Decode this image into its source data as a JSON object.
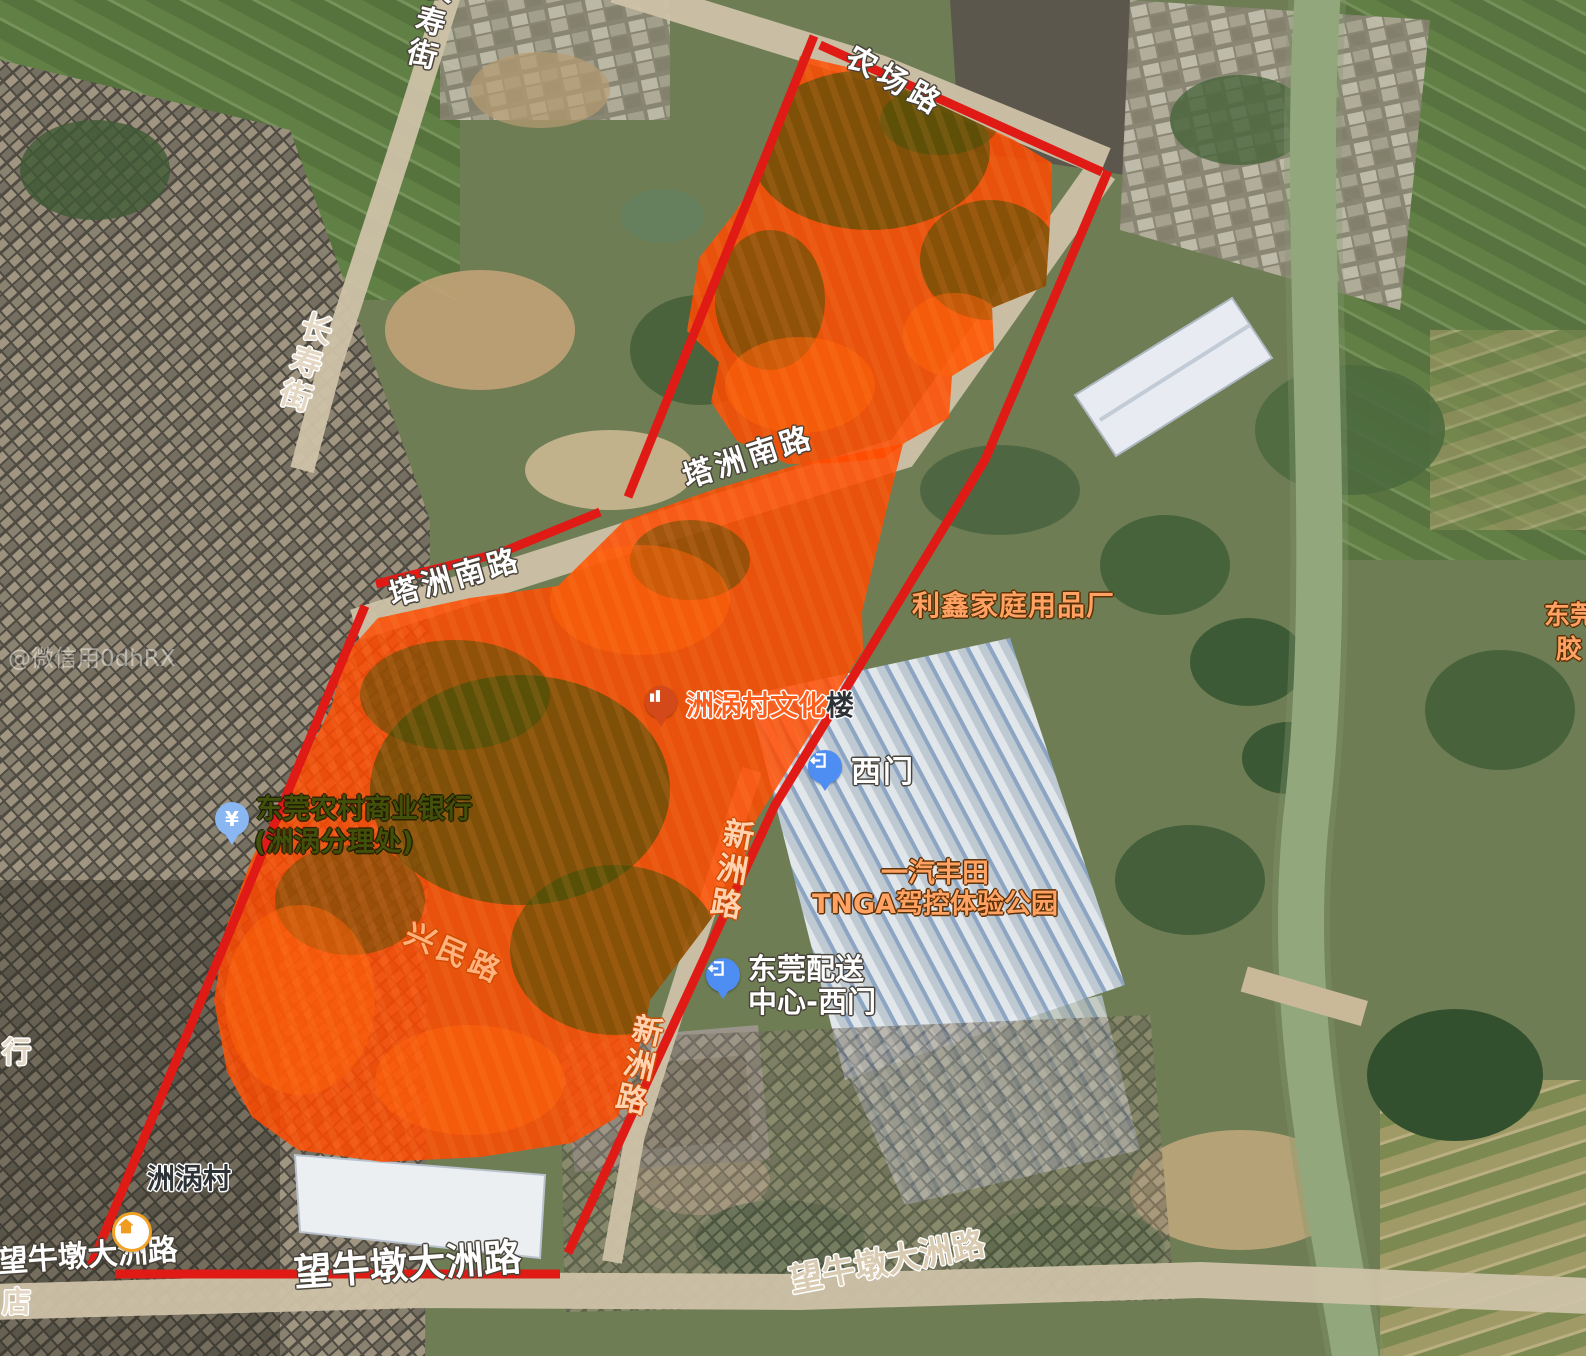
{
  "map": {
    "watermark": "@微信用0dhRX",
    "colors": {
      "boundary": "#e01b16",
      "highlight": "#ff4a00",
      "marker_blue": "#4e8df2",
      "marker_lightblue": "#8ab6f2",
      "marker_orange": "#d4491a",
      "home_orange": "#ef9c20"
    },
    "roads": {
      "changshou_top": "长寿街",
      "changshou_mid": "长寿街",
      "nongchang": "农场路",
      "tazhou_upper": "塔洲南路",
      "tazhou_lower": "塔洲南路",
      "xingmin": "兴民路",
      "xinzhou_upper": "新洲路",
      "xinzhou_lower": "新洲路",
      "wangniudun_left": "望牛墩大洲路",
      "wangniudun_mid": "望牛墩大洲路",
      "wangniudun_right": "望牛墩大洲路"
    },
    "pois": {
      "lixin": "利鑫家庭用品厂",
      "culture_main": "洲涡村文化",
      "culture_suffix": "楼",
      "ximen": "西门",
      "bank1": "东莞农村商业银行",
      "bank2": "(洲涡分理处)",
      "toyota1": "一汽丰田",
      "toyota2": "TNGA驾控体验公园",
      "delivery1": "东莞配送",
      "delivery2": "中心-西门",
      "zhouwo_village": "洲涡村",
      "edge_dongguan": "东莞",
      "edge_jiao": "胶",
      "edge_hang": "行",
      "edge_dian": "店"
    },
    "marker_glyphs": {
      "bank": "¥"
    }
  }
}
